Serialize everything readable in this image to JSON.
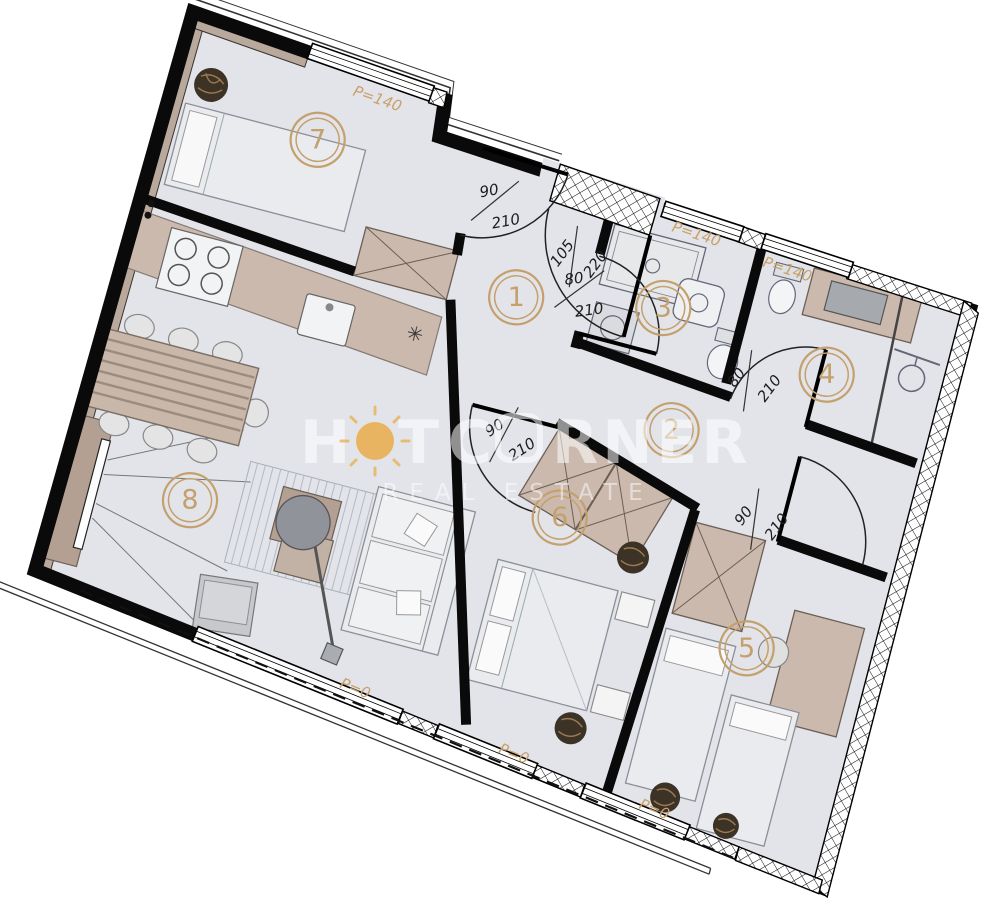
{
  "rooms": [
    {
      "number": "1"
    },
    {
      "number": "2"
    },
    {
      "number": "3"
    },
    {
      "number": "4"
    },
    {
      "number": "5"
    },
    {
      "number": "6"
    },
    {
      "number": "7"
    },
    {
      "number": "8"
    }
  ],
  "doors": [
    {
      "w": "90",
      "h": "210",
      "location": "room-7"
    },
    {
      "w": "105",
      "h": "220",
      "location": "entrance"
    },
    {
      "w": "80",
      "h": "210",
      "location": "room-3"
    },
    {
      "w": "80",
      "h": "210",
      "location": "room-4"
    },
    {
      "w": "90",
      "h": "210",
      "location": "room-6"
    },
    {
      "w": "90",
      "h": "210",
      "location": "room-5"
    }
  ],
  "windows": [
    {
      "label": "P=140",
      "location": "room-7-north"
    },
    {
      "label": "P=140",
      "location": "room-3-north"
    },
    {
      "label": "P=140",
      "location": "room-4-north"
    },
    {
      "label": "P=0",
      "location": "room-8-south"
    },
    {
      "label": "P=0",
      "location": "room-6-south"
    },
    {
      "label": "P=0",
      "location": "room-5-south"
    }
  ],
  "symbols": {
    "dishwasher": "✳"
  },
  "watermark": {
    "brand_h": "H",
    "brand_t": "T",
    "brand_c": "C",
    "brand_rner": "RNER",
    "tagline": "REAL ESTATE"
  },
  "colors": {
    "floor": "#e2e4ea",
    "accent": "#c9a06a",
    "furniture_tan": "#cbb9ad",
    "wood": "#b3a093",
    "wall": "#0a0a0a",
    "sun": "#eba93f"
  }
}
